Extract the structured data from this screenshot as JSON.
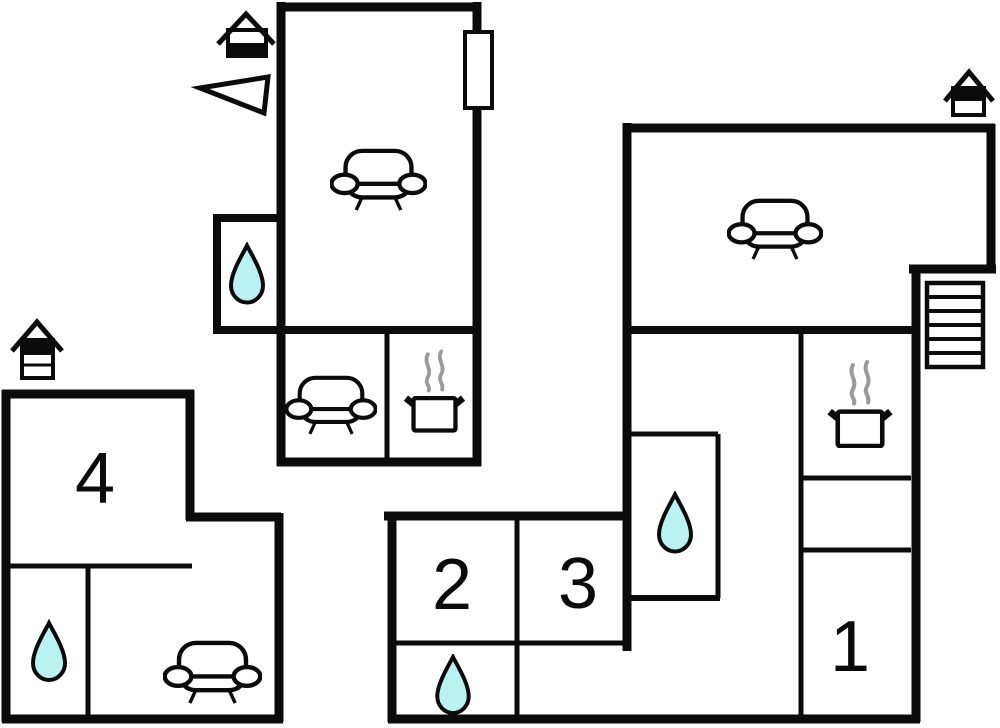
{
  "plan": {
    "type": "vacation-home-floor-plan",
    "colors": {
      "wall": "#0b0b0b",
      "water": "#b9f2f0",
      "steam": "#9a9a9a",
      "background": "#ffffff"
    },
    "rooms": {
      "room1": {
        "label": "1"
      },
      "room2": {
        "label": "2"
      },
      "room3": {
        "label": "3"
      },
      "room4": {
        "label": "4"
      }
    },
    "icons": {
      "entrance": "house-icon",
      "bathroom": "water-drop-icon",
      "lounge": "sofa-icon",
      "kitchen": "cooking-pot-icon",
      "stairs": "stairs-icon",
      "orientation": "north-arrow-icon",
      "door": "door-marker"
    },
    "counts": {
      "entrances": 3,
      "water_drops": 4,
      "sofas": 4,
      "cooking_pots": 2,
      "staircases": 1
    }
  }
}
